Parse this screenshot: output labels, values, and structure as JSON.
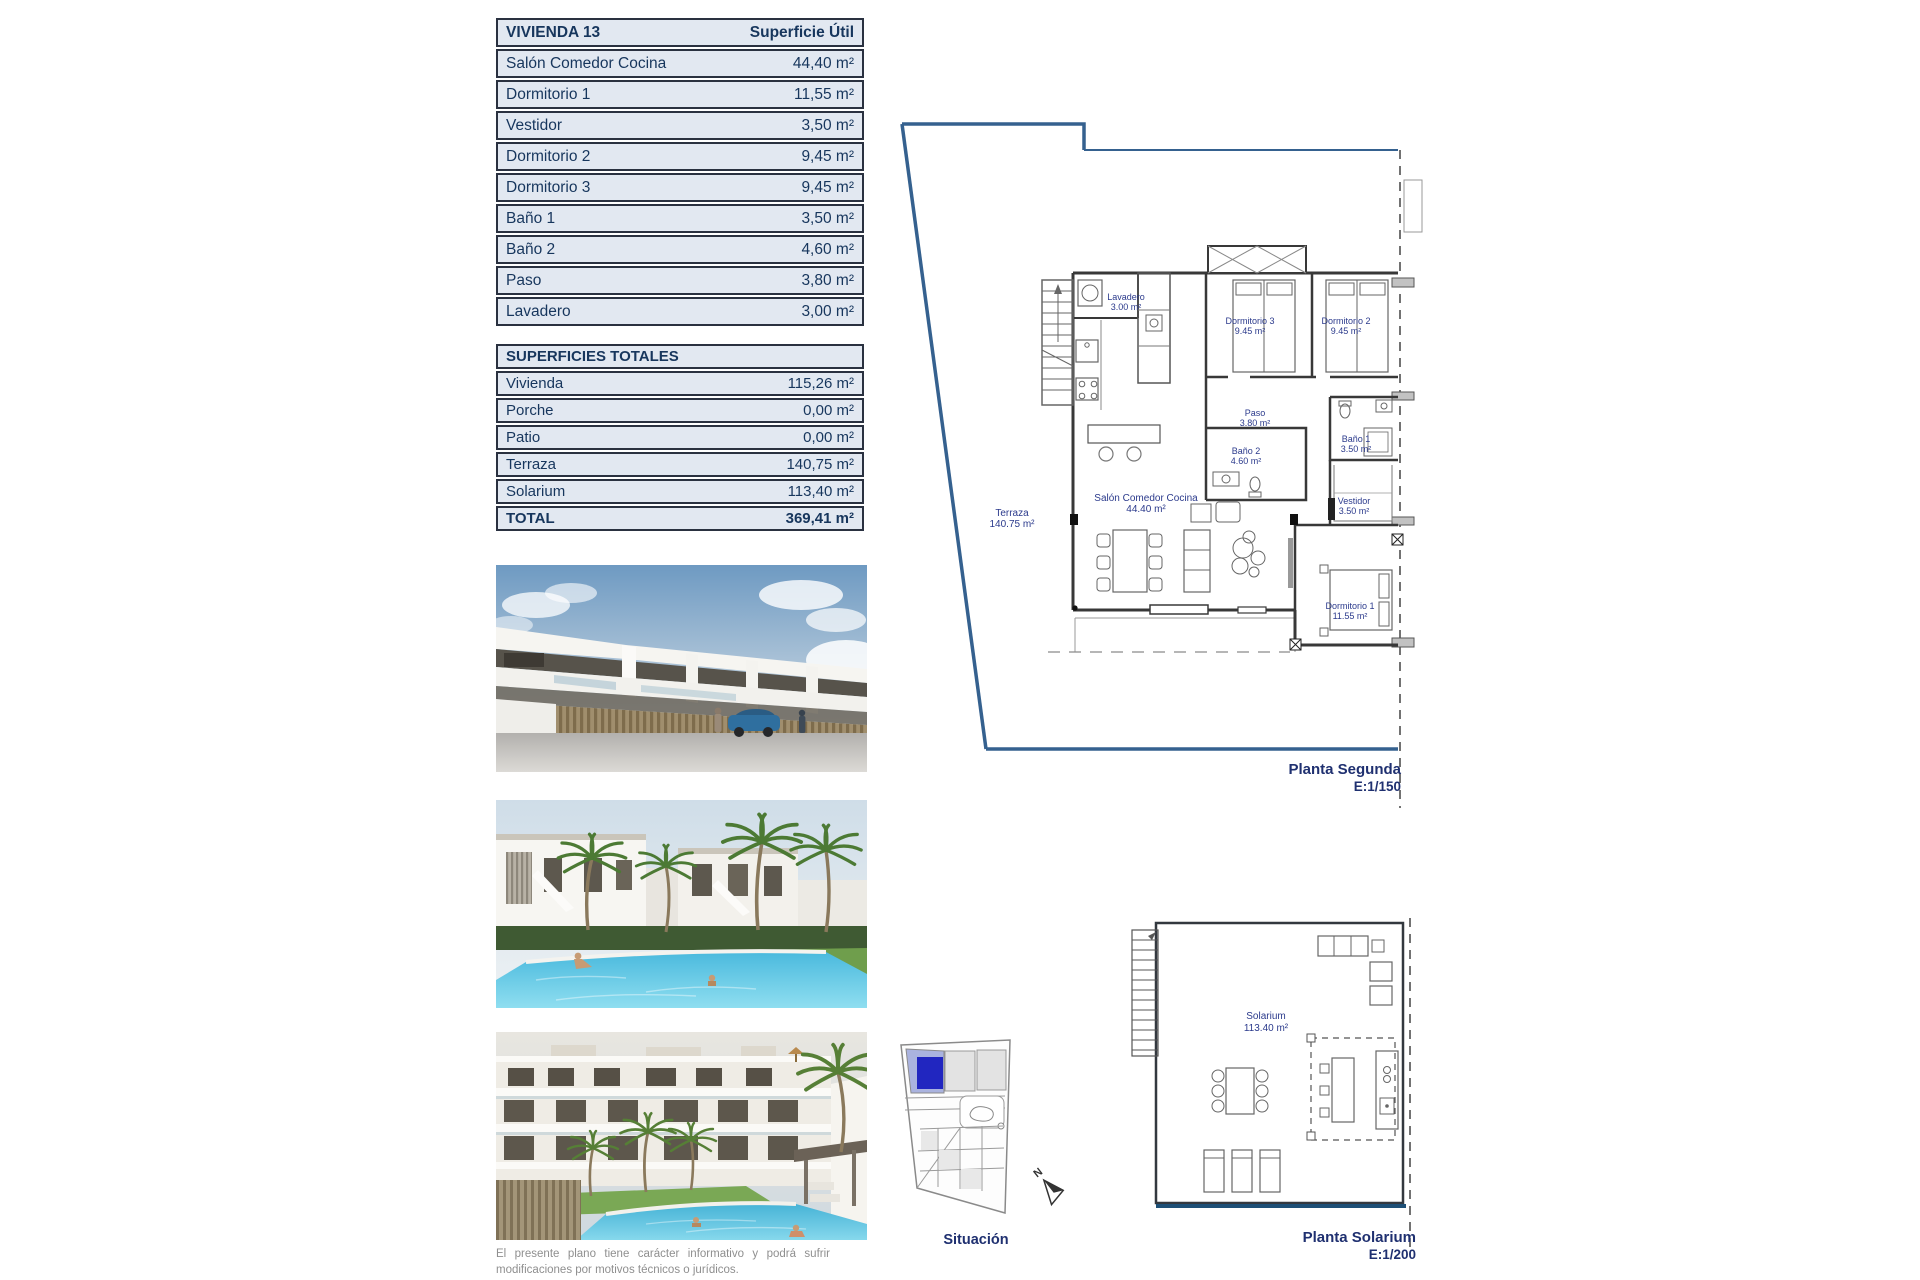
{
  "colors": {
    "table_bg": "#e2e8f1",
    "table_border": "#2a3140",
    "navy_text": "#17365d",
    "room_label": "#2b3a8c",
    "plan_title": "#1f3070",
    "terrace_outline_blue": "#35618f",
    "solarium_edge_blue": "#1d4f76",
    "situacion_plot_blue": "#2126c0",
    "pool_water": "#49b9dd"
  },
  "table_vivienda": {
    "title": "VIVIENDA 13",
    "col_header": "Superficie Útil",
    "rows": [
      {
        "label": "Salón Comedor Cocina",
        "value": "44,40 m²"
      },
      {
        "label": "Dormitorio 1",
        "value": "11,55 m²"
      },
      {
        "label": "Vestidor",
        "value": "3,50 m²"
      },
      {
        "label": "Dormitorio 2",
        "value": "9,45 m²"
      },
      {
        "label": "Dormitorio 3",
        "value": "9,45 m²"
      },
      {
        "label": "Baño 1",
        "value": "3,50 m²"
      },
      {
        "label": "Baño 2",
        "value": "4,60 m²"
      },
      {
        "label": "Paso",
        "value": "3,80 m²"
      },
      {
        "label": "Lavadero",
        "value": "3,00 m²"
      }
    ]
  },
  "table_totales": {
    "title": "SUPERFICIES TOTALES",
    "rows": [
      {
        "label": "Vivienda",
        "value": "115,26 m²"
      },
      {
        "label": "Porche",
        "value": "0,00 m²"
      },
      {
        "label": "Patio",
        "value": "0,00 m²"
      },
      {
        "label": "Terraza",
        "value": "140,75 m²"
      },
      {
        "label": "Solarium",
        "value": "113,40 m²"
      }
    ],
    "total": {
      "label": "TOTAL",
      "value": "369,41 m²"
    }
  },
  "plan_segunda": {
    "title": "Planta Segunda",
    "scale": "E:1/150",
    "rooms": {
      "lavadero": {
        "name": "Lavadero",
        "area": "3.00 m²"
      },
      "dorm3": {
        "name": "Dormitorio 3",
        "area": "9.45 m²"
      },
      "dorm2": {
        "name": "Dormitorio 2",
        "area": "9.45 m²"
      },
      "paso": {
        "name": "Paso",
        "area": "3.80 m²"
      },
      "bano2": {
        "name": "Baño 2",
        "area": "4.60 m²"
      },
      "bano1": {
        "name": "Baño 1",
        "area": "3.50 m²"
      },
      "vestidor": {
        "name": "Vestidor",
        "area": "3.50 m²"
      },
      "salon": {
        "name": "Salón Comedor Cocina",
        "area": "44.40 m²"
      },
      "dorm1": {
        "name": "Dormitorio 1",
        "area": "11.55 m²"
      },
      "terraza": {
        "name": "Terraza",
        "area": "140.75 m²"
      }
    }
  },
  "plan_solarium": {
    "title": "Planta Solarium",
    "scale": "E:1/200",
    "room": {
      "name": "Solarium",
      "area": "113.40 m²"
    }
  },
  "situacion": {
    "title": "Situación",
    "compass": "N"
  },
  "disclaimer": "El presente plano tiene carácter informativo y podrá sufrir modificaciones por motivos técnicos o jurídicos."
}
